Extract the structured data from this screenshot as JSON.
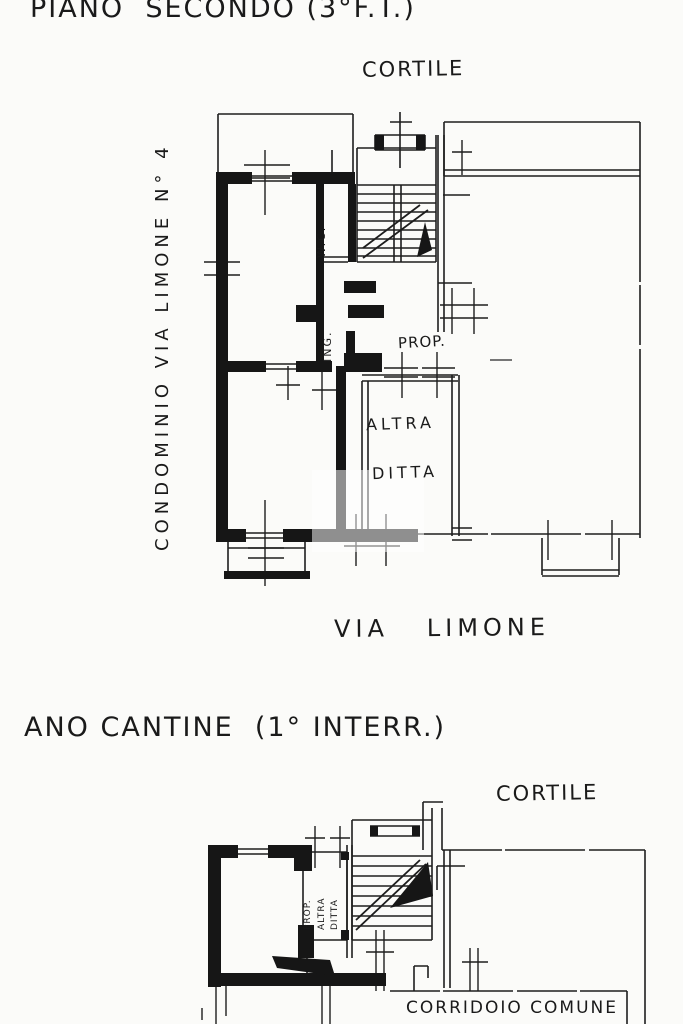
{
  "upper_plan": {
    "title": "PIANO  SECONDO (3°F.T.)",
    "labels": {
      "cortile": "CORTILE",
      "street": "VIA   LIMONE",
      "left_margin": "CONDOMINIO VIA LIMONE N° 4",
      "wc": "W.C.",
      "ing": "ING.",
      "prop": "PROP.",
      "altra": "ALTRA",
      "ditta": "DITTA"
    }
  },
  "lower_plan": {
    "title": "ANO CANTINE  (1° INTERR.)",
    "labels": {
      "cortile": "CORTILE",
      "cell_prop": "PROP.",
      "cell_altra": "ALTRA",
      "cell_ditta": "DITTA",
      "corridoio": "CORRIDOIO COMUNE"
    }
  },
  "colors": {
    "ink": "#1a1a1a",
    "paper": "#fbfbf9"
  }
}
